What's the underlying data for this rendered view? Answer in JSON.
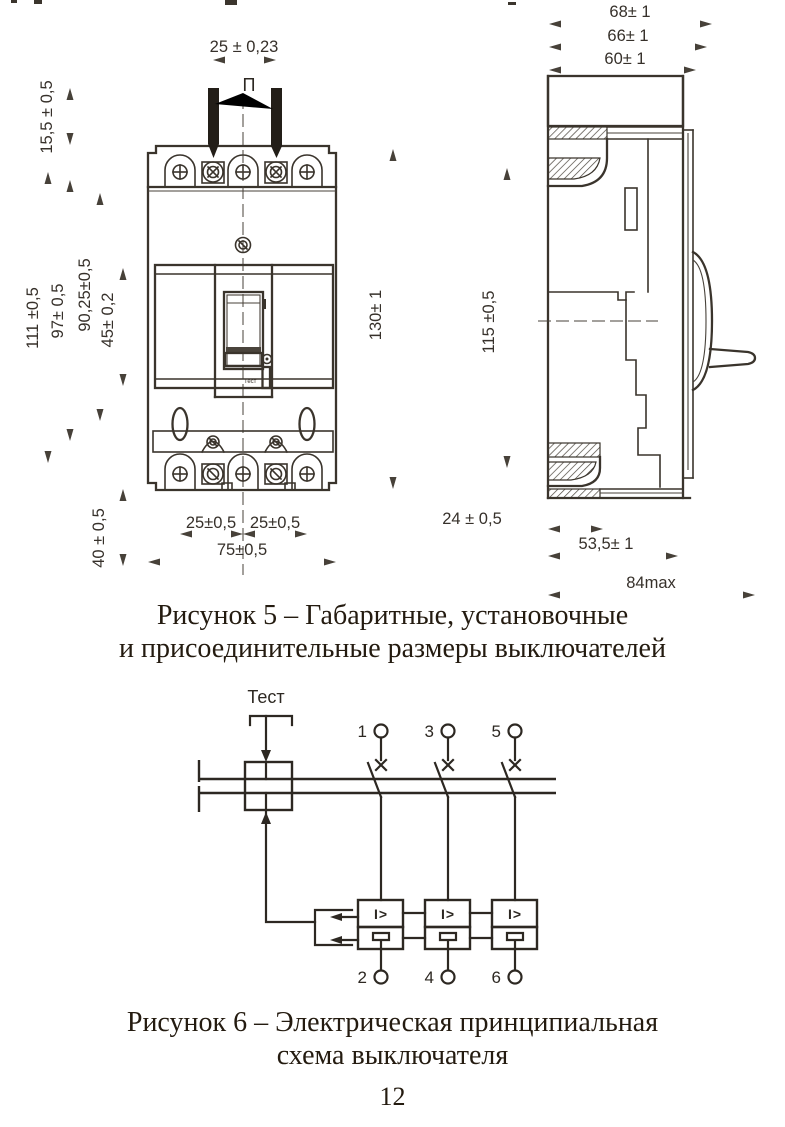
{
  "page": {
    "number": "12"
  },
  "figure5": {
    "caption_line1": "Рисунок 5 – Габаритные, установочные",
    "caption_line2": "и присоединительные размеры выключателей",
    "front": {
      "pin_pitch_label": "П",
      "test_button_label": "Тест",
      "dims": {
        "pin_spacing": "25 ± 0,23",
        "pin_height": "15,5 ± 0,5",
        "h111": "111 ±0,5",
        "h97": "97± 0,5",
        "h90": "90,25±0,5",
        "h45": "45± 0,2",
        "height": "130± 1",
        "h40": "40 ± 0,5",
        "pole_pitch_left": "25±0,5",
        "pole_pitch_right": "25±0,5",
        "width": "75±0,5"
      }
    },
    "side": {
      "dims": {
        "depth68": "68± 1",
        "depth66": "66± 1",
        "depth60": "60± 1",
        "h115": "115 ±0,5",
        "d24": "24 ± 0,5",
        "d53": "53,5± 1",
        "d84": "84max"
      }
    }
  },
  "figure6": {
    "caption_line1": "Рисунок 6 – Электрическая принципиальная",
    "caption_line2": "схема выключателя",
    "test_label": "Тест",
    "release_symbol": "I>",
    "terminals": {
      "t1": "1",
      "t3": "3",
      "t5": "5",
      "t2": "2",
      "t4": "4",
      "t6": "6"
    }
  }
}
